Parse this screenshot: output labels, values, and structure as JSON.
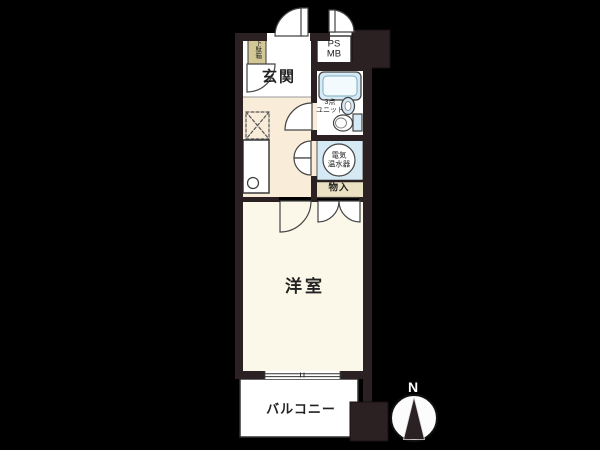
{
  "colors": {
    "wall": "#2b2123",
    "bg": "#000000",
    "kitchen_floor": "#f9edda",
    "room_floor": "#fbf8ea",
    "fixture_blue": "#d6eaf5",
    "tan": "#eae0c2",
    "khaki": "#d3c795",
    "line": "#444444"
  },
  "labels": {
    "genkan": "玄関",
    "shoe_cabinet": "下駄箱",
    "ps": "PS",
    "mb": "MB",
    "unit_bath_l1": "3点",
    "unit_bath_l2": "ユニット",
    "water_heater_l1": "電気",
    "water_heater_l2": "温水器",
    "storage": "物入",
    "room": "洋室",
    "balcony": "バルコニー",
    "north": "N"
  }
}
